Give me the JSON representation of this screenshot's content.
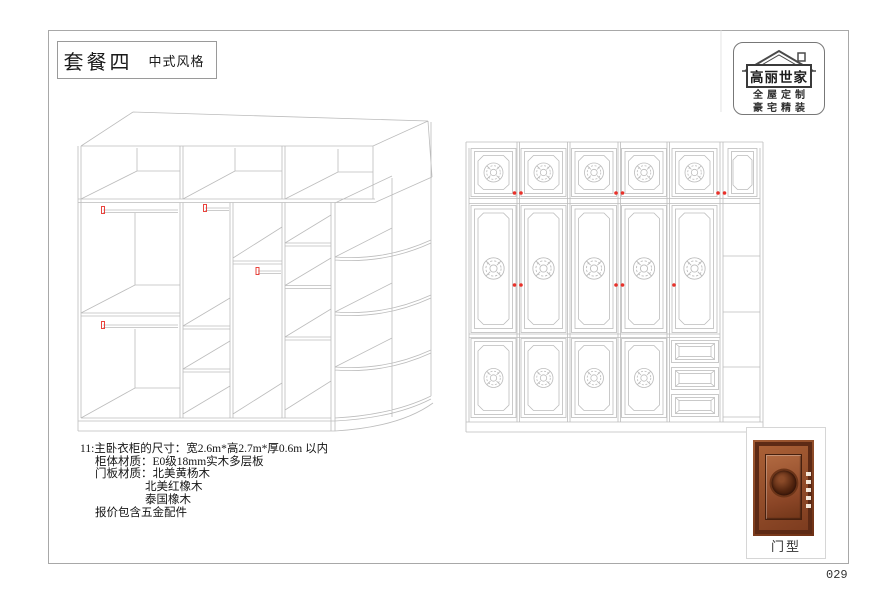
{
  "header": {
    "package_title": "套餐四",
    "style_label": "中式风格"
  },
  "logo": {
    "brand": "高丽世家",
    "tagline1": "全屋定制",
    "tagline2": "豪宅精装"
  },
  "specs": {
    "lines": [
      {
        "text": "11:主卧衣柜的尺寸：宽2.6m*高2.7m*厚0.6m 以内"
      },
      {
        "text": "柜体材质：E0级18mm实木多层板"
      },
      {
        "text": "门板材质：北美黄杨木"
      },
      {
        "text": "北美红橡木"
      },
      {
        "text": "泰国橡木"
      },
      {
        "text": "报价包含五金配件"
      }
    ]
  },
  "door_sample": {
    "label": "门型"
  },
  "page": {
    "number": "029"
  },
  "colors": {
    "line_gray": "#bcbcbc",
    "accent_red": "#e8312a",
    "wood_frame": "#5d2a15",
    "wood_panel": "#9a5632"
  }
}
